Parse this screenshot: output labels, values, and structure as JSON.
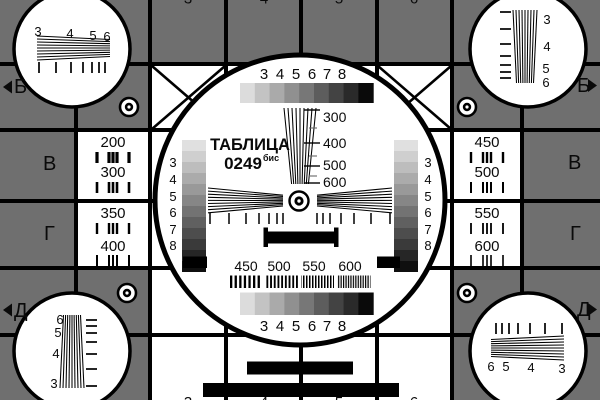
{
  "colors": {
    "bg": "#6f6f6f",
    "line": "#000000",
    "white": "#ffffff",
    "text": "#0a0a0a"
  },
  "title": {
    "word": "ТАБЛИЦА",
    "number": "0249",
    "suffix": "бис"
  },
  "grays9": [
    "#dcdcdc",
    "#c3c3c3",
    "#aaaaaa",
    "#909090",
    "#777777",
    "#5d5d5d",
    "#434343",
    "#2a2a2a",
    "#0a0a0a"
  ],
  "grays12": [
    "#e0e0e0",
    "#cfcfcf",
    "#bdbdbd",
    "#ababab",
    "#999999",
    "#868686",
    "#737373",
    "#606060",
    "#4d4d4d",
    "#3a3a3a",
    "#262626",
    "#0f0f0f"
  ],
  "edge_digits": {
    "top": [
      "3",
      "4",
      "5",
      "6"
    ],
    "bottom": [
      "3",
      "4",
      "5",
      "6"
    ]
  },
  "row_letters": {
    "left": [
      "Б",
      "В",
      "Г",
      "Д"
    ],
    "right": [
      "Б",
      "В",
      "Г",
      "Д"
    ]
  },
  "side_columns": {
    "left": [
      "200",
      "300",
      "350",
      "400"
    ],
    "right": [
      "450",
      "500",
      "550",
      "600"
    ]
  },
  "corners": {
    "top_left": [
      "3",
      "4",
      "5",
      "6"
    ],
    "top_right": [
      "3",
      "4",
      "5",
      "6"
    ],
    "bottom_left": [
      "6",
      "5",
      "4",
      "3"
    ],
    "bottom_right": [
      "6",
      "5",
      "4",
      "3"
    ]
  },
  "center": {
    "top_digits": [
      "3",
      "4",
      "5",
      "6",
      "7",
      "8"
    ],
    "bottom_digits": [
      "3",
      "4",
      "5",
      "6",
      "7",
      "8"
    ],
    "stair_digits": [
      "3",
      "4",
      "5",
      "6",
      "7",
      "8"
    ],
    "wedge_labels": [
      "300",
      "400",
      "500",
      "600"
    ],
    "freq_labels": [
      "450",
      "500",
      "550",
      "600"
    ]
  }
}
